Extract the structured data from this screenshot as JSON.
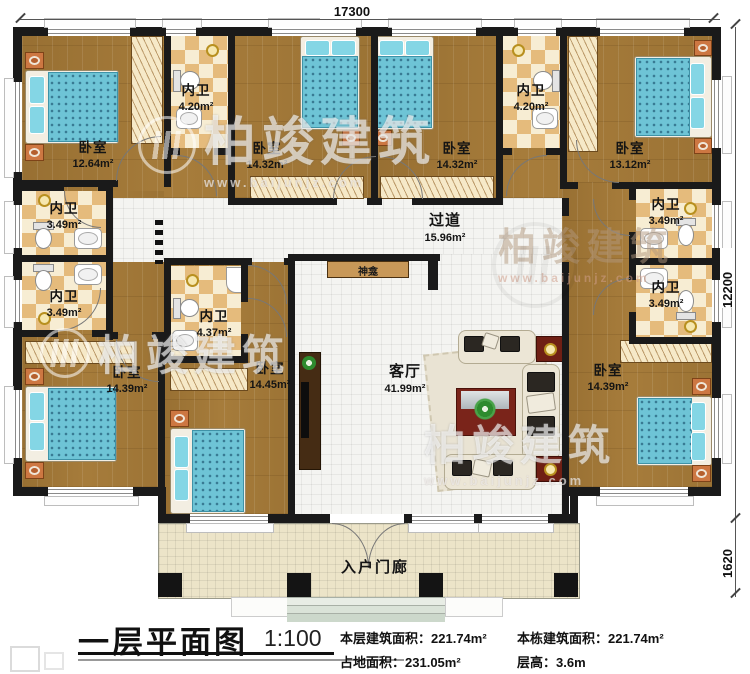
{
  "title": {
    "main": "一层平面图",
    "scale": "1:100"
  },
  "info": {
    "floor_area_label": "本层建筑面积：",
    "floor_area_value": "221.74m²",
    "building_area_label": "本栋建筑面积：",
    "building_area_value": "221.74m²",
    "land_area_label": "占地面积：",
    "land_area_value": "231.05m²",
    "height_label": "层高：",
    "height_value": "3.6m"
  },
  "dimensions": {
    "width": "17300",
    "height_main": "12200",
    "height_porch": "1620"
  },
  "rooms": [
    {
      "name": "卧室",
      "area": "12.64m²"
    },
    {
      "name": "内卫",
      "area": "4.20m²"
    },
    {
      "name": "卧室",
      "area": "14.32m²"
    },
    {
      "name": "卧室",
      "area": "14.32m²"
    },
    {
      "name": "内卫",
      "area": "4.20m²"
    },
    {
      "name": "卧室",
      "area": "13.12m²"
    },
    {
      "name": "内卫",
      "area": "3.49m²"
    },
    {
      "name": "内卫",
      "area": "3.49m²"
    },
    {
      "name": "内卫",
      "area": "4.37m²"
    },
    {
      "name": "过道",
      "area": "15.96m²"
    },
    {
      "name": "内卫",
      "area": "3.49m²"
    },
    {
      "name": "内卫",
      "area": "3.49m²"
    },
    {
      "name": "卧室",
      "area": "14.39m²"
    },
    {
      "name": "卧室",
      "area": "14.45m²"
    },
    {
      "name": "客厅",
      "area": "41.99m²"
    },
    {
      "name": "卧室",
      "area": "14.39m²"
    }
  ],
  "labels": {
    "porch": "入户门廊",
    "shrine": "神龛"
  },
  "watermark": {
    "brand": "柏竣建筑",
    "url": "www.baijunjz.com"
  },
  "colors": {
    "wall": "#1a1a1a",
    "wood": "#a67c3b",
    "checker_dark": "#e5bb7c",
    "tile": "#f4f4f1",
    "porch": "#ece4c8",
    "bed_blue": "#6ec4d6",
    "accent_red": "#7a241a"
  }
}
